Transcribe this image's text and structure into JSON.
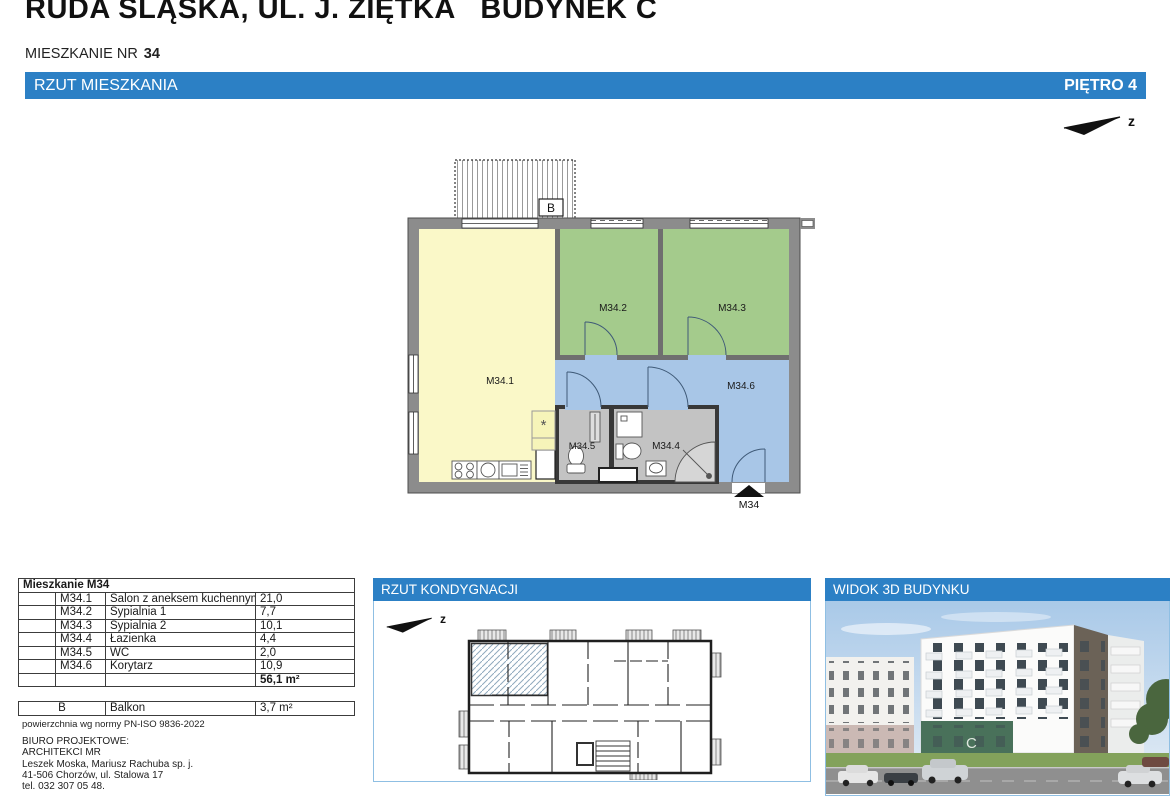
{
  "title": "RUDA ŚLĄSKA, UL. J. ZIĘTKA   BUDYNEK C",
  "subtitle": {
    "label": "MIESZKANIE NR",
    "number": "34"
  },
  "main_bar": {
    "left": "RZUT MIESZKANIA",
    "right": "PIĘTRO 4"
  },
  "north_arrow": {
    "label": "z"
  },
  "floor_plan": {
    "balcony": "B",
    "entrance": "M34",
    "kitchen_symbol": "*",
    "rooms": {
      "m341": "M34.1",
      "m342": "M34.2",
      "m343": "M34.3",
      "m344": "M34.4",
      "m345": "M34.5",
      "m346": "M34.6"
    }
  },
  "area_table": {
    "header": "Mieszkanie M34",
    "rows": [
      {
        "code": "M34.1",
        "name": "Salon z aneksem kuchennym",
        "area": "21,0"
      },
      {
        "code": "M34.2",
        "name": "Sypialnia 1",
        "area": "7,7"
      },
      {
        "code": "M34.3",
        "name": "Sypialnia 2",
        "area": "10,1"
      },
      {
        "code": "M34.4",
        "name": "Łazienka",
        "area": "4,4"
      },
      {
        "code": "M34.5",
        "name": "WC",
        "area": "2,0"
      },
      {
        "code": "M34.6",
        "name": "Korytarz",
        "area": "10,9"
      }
    ],
    "total": "56,1 m²"
  },
  "balcony_table": {
    "code": "B",
    "name": "Balkon",
    "area": "3,7 m²"
  },
  "footnote": "powierzchnia wg normy PN-ISO 9836-2022",
  "office": {
    "heading": "BIURO PROJEKTOWE:",
    "name": "ARCHITEKCI MR",
    "partners": "Leszek Moska, Mariusz Rachuba sp. j.",
    "address": "41-506 Chorzów, ul. Stalowa 17",
    "phone": "tel. 032 307 05 48."
  },
  "panels": {
    "storey": {
      "title": "RZUT KONDYGNACJI",
      "north_label": "z"
    },
    "view3d": {
      "title": "WIDOK 3D BUDYNKU",
      "building_letter": "C"
    }
  },
  "colors": {
    "accent_blue": "#2C80C5",
    "room_yellow": "#FAF8C8",
    "room_green": "#A4CB8C",
    "room_blue": "#A8C6E7",
    "room_gray": "#C3C3C3"
  }
}
